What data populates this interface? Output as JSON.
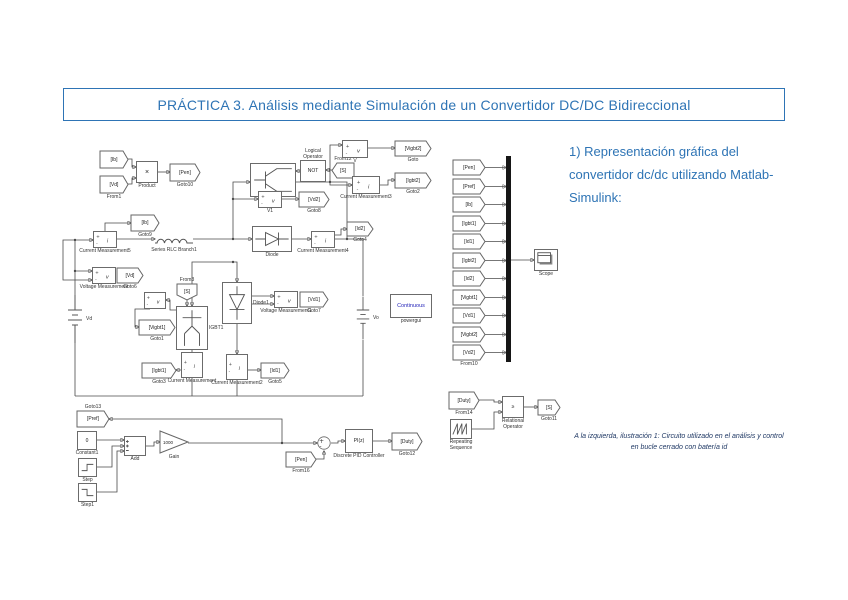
{
  "title": {
    "text": "PRÁCTICA 3. Análisis mediante Simulación de un Convertidor DC/DC Bidireccional",
    "color": "#2E74B5"
  },
  "section": {
    "heading": "1) Representación gráfica del convertidor dc/dc utilizando Matlab-Simulink:"
  },
  "caption": {
    "text": "A la izquierda, ilustración 1: Circuito utilizado en el análisis y control en bucle cerrado con batería id"
  },
  "diagram": {
    "stroke": "#4a4a4a",
    "blocks": [
      {
        "name": "from-ib",
        "shape": "tag",
        "tag": "[Ib]",
        "x": 100,
        "y": 151,
        "w": 28,
        "h": 17
      },
      {
        "name": "from1-vd",
        "shape": "tag",
        "tag": "[Vd]",
        "label": "From1",
        "x": 100,
        "y": 176,
        "w": 28,
        "h": 17
      },
      {
        "name": "product-block",
        "shape": "rect",
        "sym": "×",
        "scls": "big",
        "label": "Product",
        "x": 136,
        "y": 161,
        "w": 22,
        "h": 22
      },
      {
        "name": "goto10-pen",
        "shape": "tag",
        "tag": "[Pen]",
        "label": "Goto10",
        "x": 170,
        "y": 164,
        "w": 30,
        "h": 17
      },
      {
        "name": "igbt-block",
        "shape": "rect",
        "icon": "igbt",
        "label": "IGBT",
        "x": 250,
        "y": 163,
        "w": 46,
        "h": 34
      },
      {
        "name": "logical-operator-not",
        "shape": "rect",
        "sym": "NOT",
        "label": "Logical Operator",
        "lpos": "above",
        "lw": 36,
        "x": 300,
        "y": 160,
        "w": 26,
        "h": 22
      },
      {
        "name": "from12-s",
        "shape": "tag",
        "tag": "[S]",
        "dir": "left",
        "label": "From12",
        "lpos": "above",
        "x": 332,
        "y": 163,
        "w": 22,
        "h": 15
      },
      {
        "name": "voltage-meas-v",
        "shape": "rect",
        "icon": "vmeas",
        "label": "V",
        "x": 342,
        "y": 140,
        "w": 26,
        "h": 18
      },
      {
        "name": "goto-vigbt2",
        "shape": "tag",
        "tag": "[Vigbt2]",
        "label": "Goto",
        "x": 395,
        "y": 141,
        "w": 36,
        "h": 15
      },
      {
        "name": "current-meas3",
        "shape": "rect",
        "icon": "imeas",
        "label": "Current Measurement3",
        "x": 352,
        "y": 176,
        "w": 28,
        "h": 18
      },
      {
        "name": "goto2-igbt2",
        "shape": "tag",
        "tag": "[Igbt2]",
        "label": "Goto2",
        "x": 395,
        "y": 173,
        "w": 36,
        "h": 15
      },
      {
        "name": "voltage-meas-v1",
        "shape": "rect",
        "icon": "vmeas",
        "label": "V1",
        "x": 258,
        "y": 191,
        "w": 24,
        "h": 17
      },
      {
        "name": "goto8-vd2",
        "shape": "tag",
        "tag": "[Vd2]",
        "label": "Goto8",
        "x": 299,
        "y": 192,
        "w": 30,
        "h": 15
      },
      {
        "name": "goto9-ib",
        "shape": "tag",
        "tag": "[Ib]",
        "label": "Goto9",
        "x": 131,
        "y": 215,
        "w": 28,
        "h": 16
      },
      {
        "name": "current-meas5",
        "shape": "rect",
        "icon": "imeas",
        "label": "Current Measurement5",
        "x": 93,
        "y": 231,
        "w": 24,
        "h": 17
      },
      {
        "name": "series-rlc-branch1",
        "shape": "plain",
        "icon": "inductor",
        "label": "Series RLC Branch1",
        "x": 155,
        "y": 232,
        "w": 38,
        "h": 14
      },
      {
        "name": "voltage-measurement",
        "shape": "rect",
        "icon": "vmeas",
        "label": "Voltage Measurement",
        "x": 92,
        "y": 267,
        "w": 24,
        "h": 17
      },
      {
        "name": "goto6-vd",
        "shape": "tag",
        "tag": "[Vd]",
        "label": "Goto6",
        "x": 117,
        "y": 268,
        "w": 26,
        "h": 15
      },
      {
        "name": "battery-vd",
        "shape": "plain",
        "icon": "battery",
        "label": "Vd",
        "lpos": "right",
        "x": 66,
        "y": 295,
        "w": 18,
        "h": 48
      },
      {
        "name": "diode-block",
        "shape": "rect",
        "icon": "diode",
        "label": "Diode",
        "x": 252,
        "y": 226,
        "w": 40,
        "h": 26
      },
      {
        "name": "current-meas4",
        "shape": "rect",
        "icon": "imeas",
        "label": "Current Measurement4",
        "x": 311,
        "y": 231,
        "w": 24,
        "h": 17
      },
      {
        "name": "goto4-id2",
        "shape": "tag",
        "tag": "[Id2]",
        "label": "Goto4",
        "x": 347,
        "y": 222,
        "w": 26,
        "h": 14
      },
      {
        "name": "from3-s",
        "shape": "tag",
        "tag": "[S]",
        "dir": "down",
        "label": "From3",
        "lpos": "above",
        "x": 177,
        "y": 284,
        "w": 20,
        "h": 16
      },
      {
        "name": "voltage-meas-igbt1",
        "shape": "rect",
        "icon": "vmeas",
        "x": 144,
        "y": 292,
        "w": 22,
        "h": 17
      },
      {
        "name": "goto1-vigbt1",
        "shape": "tag",
        "tag": "[Vigbt1]",
        "label": "Goto1",
        "x": 139,
        "y": 320,
        "w": 36,
        "h": 15
      },
      {
        "name": "igbt1-block",
        "shape": "rect",
        "icon": "igbtv",
        "label": "IGBT1",
        "lpos": "right",
        "x": 176,
        "y": 306,
        "w": 32,
        "h": 44
      },
      {
        "name": "diode1-block",
        "shape": "rect",
        "icon": "diodev",
        "label": "Diode1",
        "lpos": "right",
        "x": 222,
        "y": 282,
        "w": 30,
        "h": 42
      },
      {
        "name": "voltage-meas1",
        "shape": "rect",
        "icon": "vmeas",
        "label": "Voltage Measurement1",
        "x": 274,
        "y": 291,
        "w": 24,
        "h": 17
      },
      {
        "name": "goto7-vd1",
        "shape": "tag",
        "tag": "[Vd1]",
        "label": "Goto7",
        "x": 300,
        "y": 292,
        "w": 28,
        "h": 15
      },
      {
        "name": "current-meas1",
        "shape": "rect",
        "icon": "imeas",
        "label": "Current Measurement",
        "x": 181,
        "y": 352,
        "w": 22,
        "h": 26
      },
      {
        "name": "goto3-igbt1",
        "shape": "tag",
        "tag": "[Igbt1]",
        "label": "Goto3",
        "x": 142,
        "y": 363,
        "w": 34,
        "h": 15
      },
      {
        "name": "current-meas2",
        "shape": "rect",
        "icon": "imeas",
        "label": "Current Measurement2",
        "x": 226,
        "y": 354,
        "w": 22,
        "h": 26
      },
      {
        "name": "goto5-id1",
        "shape": "tag",
        "tag": "[Id1]",
        "label": "Goto5",
        "x": 261,
        "y": 363,
        "w": 28,
        "h": 15
      },
      {
        "name": "battery-vo",
        "shape": "plain",
        "icon": "battery",
        "label": "Vo",
        "lpos": "right",
        "x": 355,
        "y": 296,
        "w": 16,
        "h": 44
      },
      {
        "name": "powergui-block",
        "shape": "rect",
        "sym": "Continuous",
        "scls": "pg",
        "label": "powergui",
        "x": 390,
        "y": 294,
        "w": 42,
        "h": 24
      },
      {
        "name": "mux-from-pen",
        "shape": "tag",
        "tag": "[Pen]",
        "x": 453,
        "y": 160,
        "w": 32,
        "h": 15
      },
      {
        "name": "mux-from-pref",
        "shape": "tag",
        "tag": "[Pref]",
        "x": 453,
        "y": 179,
        "w": 32,
        "h": 15
      },
      {
        "name": "mux-from-ib",
        "shape": "tag",
        "tag": "[Ib]",
        "x": 453,
        "y": 197,
        "w": 32,
        "h": 15
      },
      {
        "name": "mux-from-igbt1",
        "shape": "tag",
        "tag": "[Igbt1]",
        "x": 453,
        "y": 216,
        "w": 32,
        "h": 15
      },
      {
        "name": "mux-from-id1",
        "shape": "tag",
        "tag": "[Id1]",
        "x": 453,
        "y": 234,
        "w": 32,
        "h": 15
      },
      {
        "name": "mux-from-igbt2",
        "shape": "tag",
        "tag": "[Igbt2]",
        "x": 453,
        "y": 253,
        "w": 32,
        "h": 15
      },
      {
        "name": "mux-from-id2",
        "shape": "tag",
        "tag": "[Id2]",
        "x": 453,
        "y": 271,
        "w": 32,
        "h": 15
      },
      {
        "name": "mux-from-vigbt1",
        "shape": "tag",
        "tag": "[Vigbt1]",
        "x": 453,
        "y": 290,
        "w": 32,
        "h": 15
      },
      {
        "name": "mux-from-vd1",
        "shape": "tag",
        "tag": "[Vd1]",
        "x": 453,
        "y": 308,
        "w": 32,
        "h": 15
      },
      {
        "name": "mux-from-vigbt2",
        "shape": "tag",
        "tag": "[Vigbt2]",
        "x": 453,
        "y": 327,
        "w": 32,
        "h": 15
      },
      {
        "name": "mux-from-vd2",
        "shape": "tag",
        "tag": "[Vd2]",
        "label": "From10",
        "x": 453,
        "y": 345,
        "w": 32,
        "h": 15
      },
      {
        "name": "mux-bar",
        "shape": "mux",
        "x": 506,
        "y": 156,
        "w": 5,
        "h": 206
      },
      {
        "name": "scope-block",
        "shape": "rect",
        "icon": "scope",
        "label": "Scope",
        "x": 534,
        "y": 249,
        "w": 24,
        "h": 22
      },
      {
        "name": "from14-duty",
        "shape": "tag",
        "tag": "[Duty]",
        "label": "From14",
        "x": 449,
        "y": 392,
        "w": 30,
        "h": 17
      },
      {
        "name": "repeating-sequence",
        "shape": "rect",
        "icon": "saw",
        "label": "Repeating Sequence",
        "lw": 42,
        "x": 450,
        "y": 419,
        "w": 22,
        "h": 20
      },
      {
        "name": "relational-operator",
        "shape": "rect",
        "sym": "≥",
        "label": "Relational Operator",
        "lw": 40,
        "x": 502,
        "y": 396,
        "w": 22,
        "h": 22
      },
      {
        "name": "goto11-s",
        "shape": "tag",
        "tag": "[S]",
        "label": "Goto11",
        "x": 538,
        "y": 400,
        "w": 22,
        "h": 15
      },
      {
        "name": "goto13-pref",
        "shape": "tag",
        "tag": "[Pref]",
        "label": "Goto13",
        "lpos": "above",
        "x": 77,
        "y": 411,
        "w": 32,
        "h": 16
      },
      {
        "name": "constant1-block",
        "shape": "rect",
        "sym": "0",
        "label": "Constant1",
        "x": 77,
        "y": 431,
        "w": 20,
        "h": 19
      },
      {
        "name": "step-block",
        "shape": "rect",
        "icon": "step",
        "label": "Step",
        "x": 78,
        "y": 458,
        "w": 19,
        "h": 19
      },
      {
        "name": "step1-block",
        "shape": "rect",
        "icon": "step1",
        "label": "Step1",
        "x": 78,
        "y": 483,
        "w": 19,
        "h": 19
      },
      {
        "name": "add-block",
        "shape": "rect",
        "icon": "addp",
        "label": "Add",
        "x": 124,
        "y": 436,
        "w": 22,
        "h": 20
      },
      {
        "name": "gain-block",
        "shape": "gain",
        "sym": "1000",
        "label": "Gain",
        "x": 160,
        "y": 431,
        "w": 28,
        "h": 22
      },
      {
        "name": "sum-block",
        "shape": "sum",
        "x": 317,
        "y": 436,
        "w": 14,
        "h": 14
      },
      {
        "name": "from16-pen",
        "shape": "tag",
        "tag": "[Pen]",
        "label": "From16",
        "x": 286,
        "y": 452,
        "w": 30,
        "h": 15
      },
      {
        "name": "discrete-pid-controller",
        "shape": "rect",
        "sym": "PI(z)",
        "label": "Discrete PID Controller",
        "x": 345,
        "y": 429,
        "w": 28,
        "h": 24
      },
      {
        "name": "goto12-duty",
        "shape": "tag",
        "tag": "[Duty]",
        "label": "Goto12",
        "x": 392,
        "y": 433,
        "w": 30,
        "h": 17
      }
    ]
  }
}
